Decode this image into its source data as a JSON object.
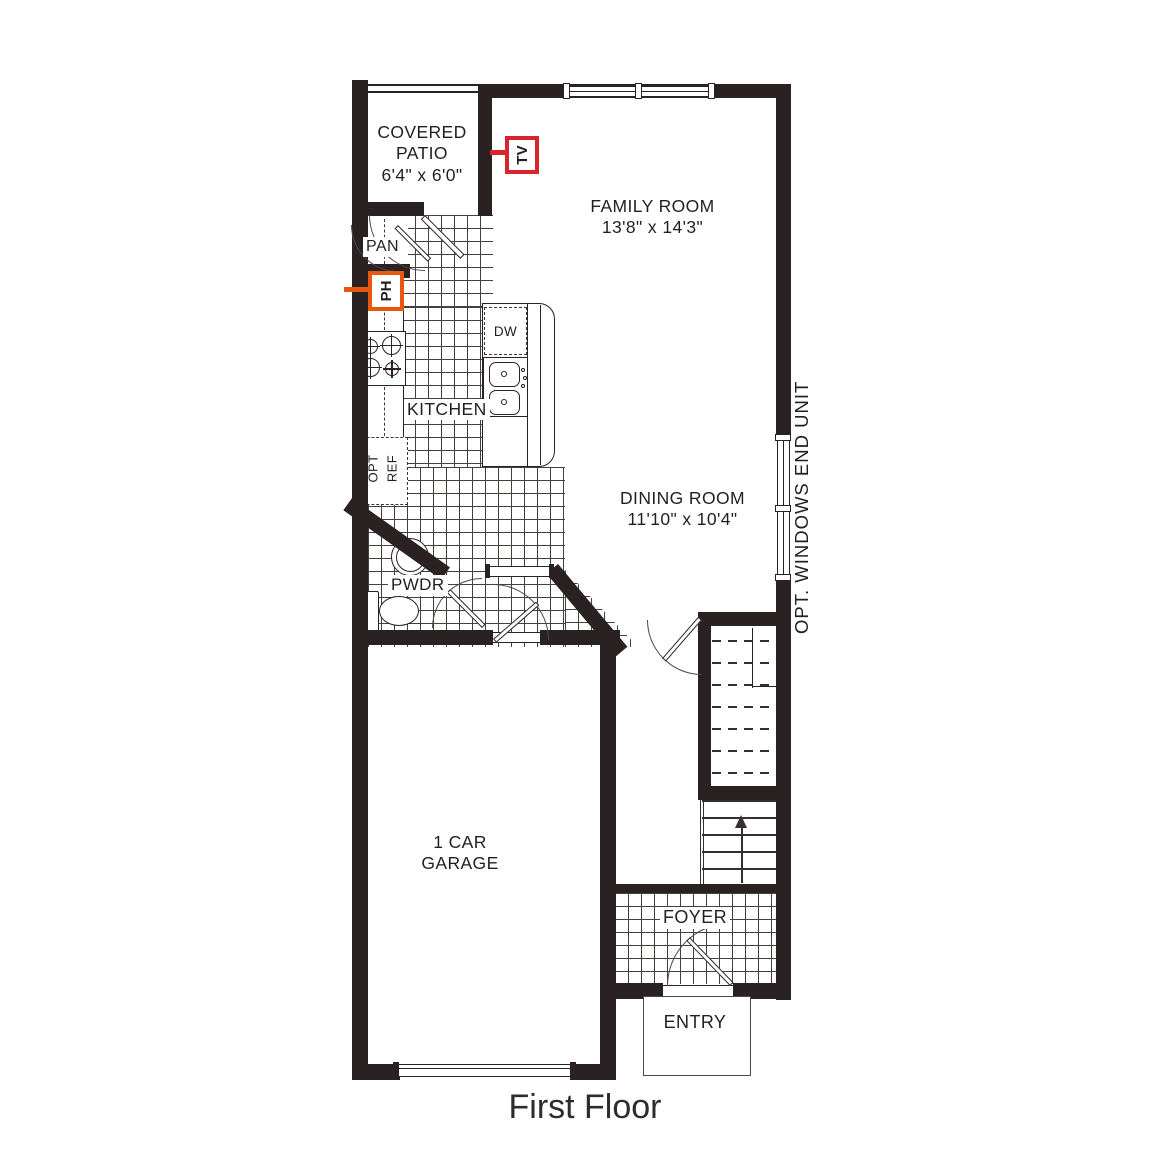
{
  "title": "First Floor",
  "rooms": {
    "covered_patio": {
      "name_line1": "COVERED",
      "name_line2": "PATIO",
      "dims": "6'4\" x 6'0\""
    },
    "family_room": {
      "name": "FAMILY ROOM",
      "dims": "13'8\" x 14'3\""
    },
    "dining_room": {
      "name": "DINING ROOM",
      "dims": "11'10\" x 10'4\""
    },
    "kitchen": {
      "name": "KITCHEN"
    },
    "pantry": {
      "name": "PAN"
    },
    "powder_room": {
      "name": "PWDR"
    },
    "garage": {
      "name_line1": "1 CAR",
      "name_line2": "GARAGE"
    },
    "foyer": {
      "name": "FOYER"
    },
    "entry": {
      "name": "ENTRY"
    }
  },
  "fixtures": {
    "dishwasher": "DW",
    "opt_refrigerator_line1": "OPT",
    "opt_refrigerator_line2": "REF"
  },
  "annotations": {
    "tv": "TV",
    "phone": "PH",
    "opt_windows_end_unit": "OPT. WINDOWS END UNIT"
  },
  "colors": {
    "wall": "#2a2122",
    "tv_accent": "#d6252b",
    "ph_accent": "#e8570e",
    "line": "#231f20"
  }
}
